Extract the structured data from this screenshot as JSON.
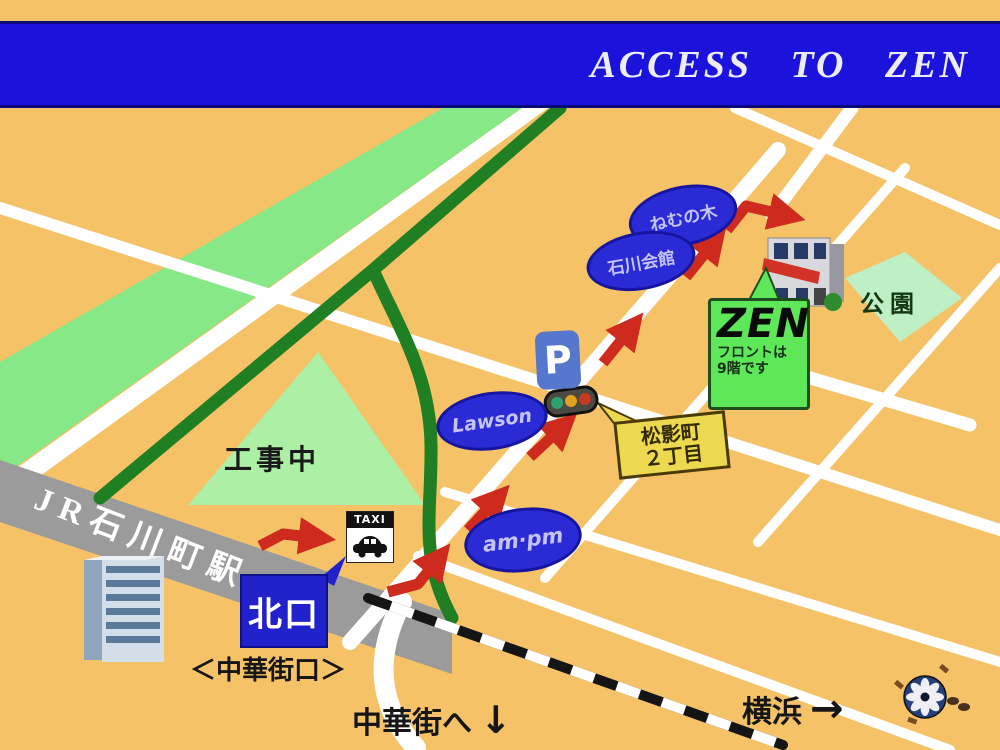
{
  "banner": {
    "title": "ACCESS  TO  ZEN"
  },
  "stations": {
    "jr_line_label": "JR石川町駅",
    "north_exit": "北口",
    "chinatown_exit_gate": "＜中華街口＞"
  },
  "directions": {
    "to_chinatown": "中華街へ",
    "to_chinatown_arrow": "↓",
    "to_yokohama": "横浜",
    "to_yokohama_arrow": "→"
  },
  "areas": {
    "under_construction": "工事中",
    "park": "公園"
  },
  "landmarks": {
    "nemunoki": "ねむの木",
    "ishikawa_kaikan": "石川会館",
    "lawson": "Lawson",
    "ampm": "am·pm",
    "parking": "P",
    "taxi": "TAXI"
  },
  "destination": {
    "name": "ZEN",
    "note_line1": "フロントは",
    "note_line2": "9階です"
  },
  "intersection": {
    "line1": "松影町",
    "line2": "２丁目"
  },
  "colors": {
    "background": "#F5C268",
    "banner_blue": "#1B12DC",
    "band_light_green": "#86E886",
    "road_dark_green": "#1F7F22",
    "route_red": "#CE2B1E",
    "station_gray": "#9B9B9B",
    "ellipse_blue": "#2B2BD5",
    "zen_green": "#5FE75A",
    "callout_yellow": "#EDD94F"
  }
}
